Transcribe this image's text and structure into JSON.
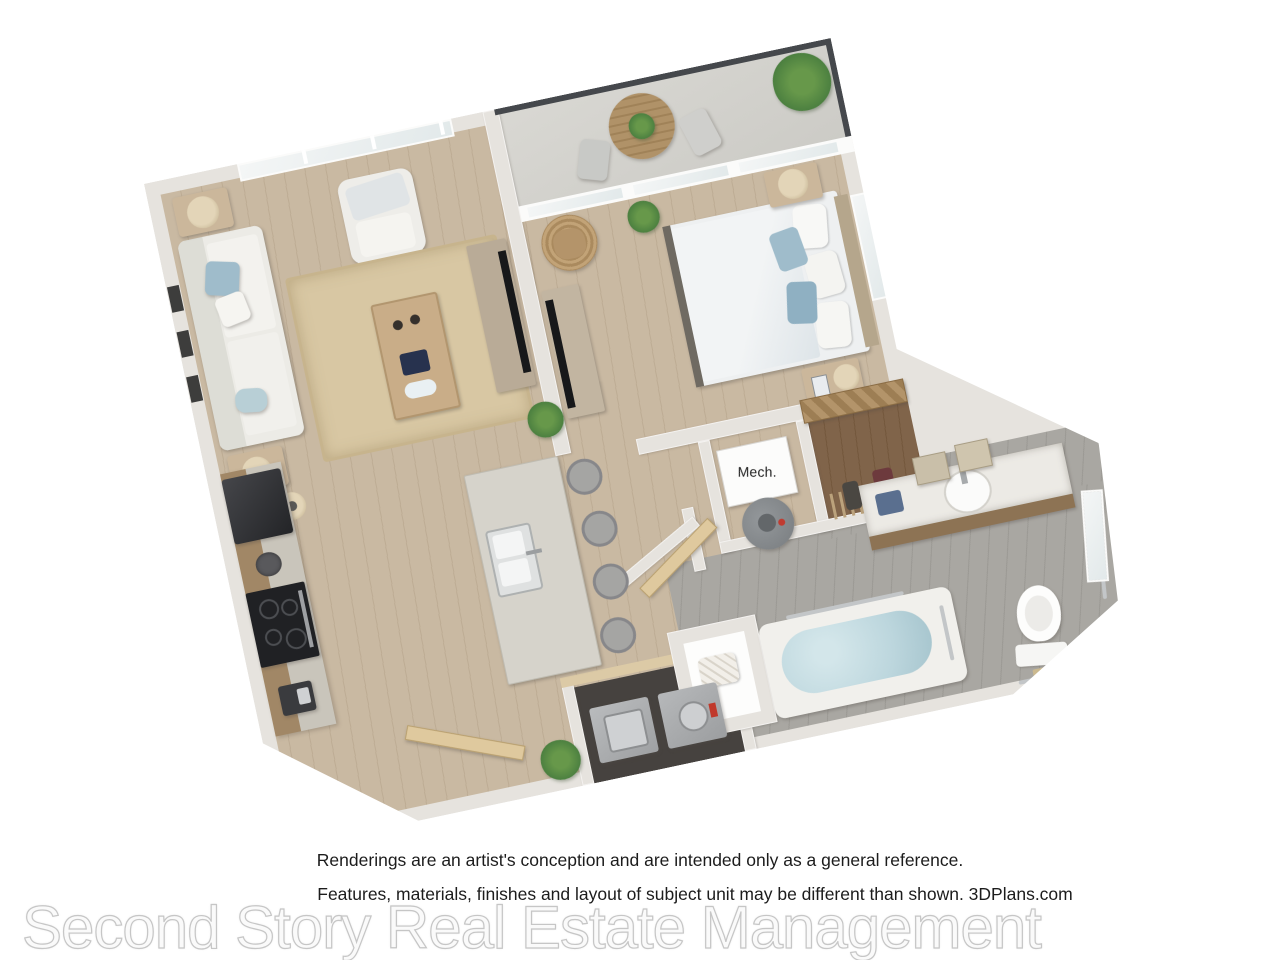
{
  "labels": {
    "mech_room": "Mech."
  },
  "disclaimer": {
    "line1": "Renderings are an artist's conception and are intended only as a general reference.",
    "line2": "Features, materials, finishes and layout of subject unit may be different than shown. 3DPlans.com"
  },
  "watermark": "Second Story Real Estate Management",
  "colors": {
    "wall": "#e6e3de",
    "floor_wood": "#c9b9a2",
    "floor_bath": "#a9a7a2",
    "floor_closet": "#80644a",
    "floor_balcony": "#d4d3ce",
    "rug": "#d8c7a3",
    "accent_blue": "#9fbccb",
    "railing": "#45484c",
    "cabinet_wood": "#a18766",
    "island": "#d6d3cb",
    "appliance_dark": "#303034",
    "water": "#bcd6dd",
    "plant": "#4c8040",
    "door_wood": "#dfc99e",
    "text": "#1c1c1c"
  }
}
